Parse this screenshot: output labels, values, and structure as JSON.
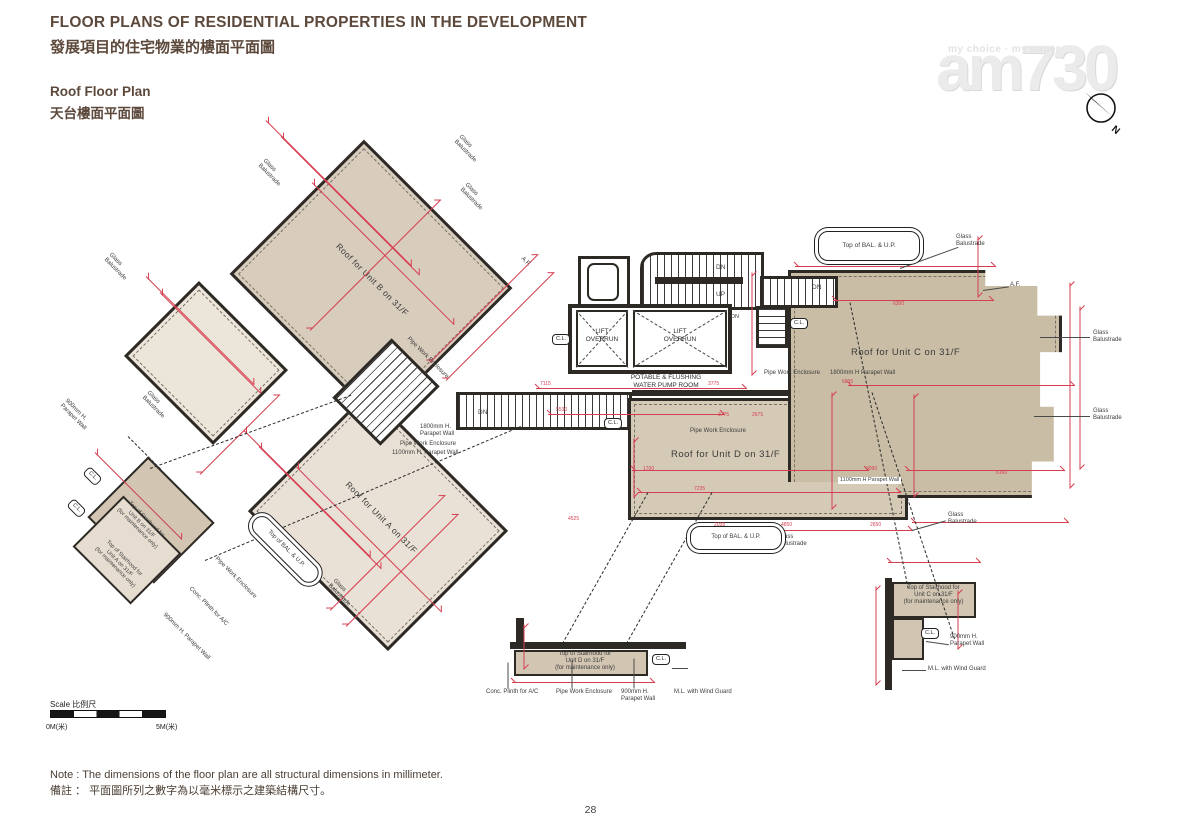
{
  "header": {
    "title_en": "FLOOR PLANS OF RESIDENTIAL PROPERTIES IN THE DEVELOPMENT",
    "title_zh": "發展項目的住宅物業的樓面平面圖",
    "subtitle_en": "Roof Floor Plan",
    "subtitle_zh": "天台樓面平面圖"
  },
  "watermark": {
    "tagline": "my choice · my paper",
    "logo": "am730",
    "compass_n": "N"
  },
  "scalebar": {
    "label": "Scale 比例尺",
    "start": "0M(米)",
    "end": "5M(米)"
  },
  "notes": {
    "en": "Note :  The dimensions of the floor plan are all structural dimensions in millimeter.",
    "zh": "備註 ： 平面圖所列之數字為以毫米標示之建築結構尺寸。"
  },
  "page_number": "28",
  "plan": {
    "rooms": {
      "unit_a": "Roof for Unit A on 31/F",
      "unit_b": "Roof for Unit B on 31/F",
      "unit_c": "Roof for Unit C on 31/F",
      "unit_d": "Roof for Unit D on 31/F",
      "lift_overrun": "LIFT\nOVERRUN",
      "pump_room": "POTABLE & FLUSHING\nWATER PUMP ROOM",
      "pipe_well": "PIPE\nWELL"
    },
    "colors": {
      "dim_red": "#d63f52",
      "wall": "#2d2a26",
      "title_brown": "#5d493c",
      "fill_unit_c": "#cabda5",
      "fill_unit_d": "#d5cab6",
      "fill_unit_b": "#d8ccbd",
      "fill_unit_a": "#e9e1d5"
    },
    "annotations": [
      {
        "t": "Glass\nBalustrade",
        "x": 462,
        "y": 134,
        "r": 45,
        "s": 6
      },
      {
        "t": "Glass\nBalustrade",
        "x": 468,
        "y": 182,
        "r": 45,
        "s": 6
      },
      {
        "t": "Glass\nBalustrade",
        "x": 266,
        "y": 158,
        "r": 45,
        "s": 6
      },
      {
        "t": "Glass\nBalustrade",
        "x": 112,
        "y": 252,
        "r": 45,
        "s": 6
      },
      {
        "t": "Glass\nBalustrade",
        "x": 150,
        "y": 390,
        "r": 45,
        "s": 6
      },
      {
        "t": "Glass\nBalustrade",
        "x": 336,
        "y": 578,
        "r": 45,
        "s": 6
      },
      {
        "t": "Glass\nBalustrade",
        "x": 956,
        "y": 234,
        "s": 6
      },
      {
        "t": "Glass\nBalustrade",
        "x": 1093,
        "y": 330,
        "s": 6
      },
      {
        "t": "Glass\nBalustrade",
        "x": 1093,
        "y": 408,
        "s": 6
      },
      {
        "t": "Glass\nBalustrade",
        "x": 948,
        "y": 512,
        "s": 6
      },
      {
        "t": "Glass\nBalustrade",
        "x": 778,
        "y": 534,
        "s": 6
      },
      {
        "t": "A.F.",
        "x": 1010,
        "y": 282,
        "s": 6
      },
      {
        "t": "A.F.",
        "x": 524,
        "y": 256,
        "r": 45,
        "s": 6
      },
      {
        "t": "Top of BAL. & U.P.",
        "x": 818,
        "y": 231,
        "w": 100,
        "h": 28,
        "cls": "balbox",
        "s": 6.5,
        "n": "top-of-bal-up-label"
      },
      {
        "t": "Top of BAL. & U.P.",
        "x": 690,
        "y": 526,
        "w": 90,
        "h": 22,
        "cls": "balbox",
        "s": 6,
        "n": "top-of-bal-up-label"
      },
      {
        "t": "Top of BAL. & U.P.",
        "x": 262,
        "y": 512,
        "w": 84,
        "h": 18,
        "r": 45,
        "cls": "balbox",
        "s": 6,
        "n": "top-of-bal-up-label"
      },
      {
        "t": "DN",
        "x": 716,
        "y": 264,
        "s": 6.5
      },
      {
        "t": "UP",
        "x": 716,
        "y": 291,
        "s": 6.5
      },
      {
        "t": "DN",
        "x": 812,
        "y": 284,
        "s": 6.5
      },
      {
        "t": "DN",
        "x": 478,
        "y": 409,
        "s": 6.5
      },
      {
        "t": "DN",
        "x": 731,
        "y": 314,
        "s": 5.5
      },
      {
        "t": "C.L.",
        "x": 552,
        "y": 334,
        "cls": "clbox"
      },
      {
        "t": "C.L.",
        "x": 604,
        "y": 418,
        "cls": "clbox"
      },
      {
        "t": "C.L.",
        "x": 790,
        "y": 318,
        "cls": "clbox"
      },
      {
        "t": "C.L.",
        "x": 921,
        "y": 628,
        "cls": "clbox"
      },
      {
        "t": "C.L.",
        "x": 652,
        "y": 654,
        "cls": "clbox"
      },
      {
        "t": "C.L.",
        "x": 90,
        "y": 466,
        "r": 45,
        "cls": "clbox"
      },
      {
        "t": "C.L.",
        "x": 74,
        "y": 498,
        "r": 45,
        "cls": "clbox"
      },
      {
        "t": "Pipe Work Enclosure",
        "x": 690,
        "y": 428,
        "s": 6
      },
      {
        "t": "Pipe Work Enclosure",
        "x": 764,
        "y": 370,
        "s": 6
      },
      {
        "t": "1800mm H Parapet Wall",
        "x": 830,
        "y": 370,
        "s": 6
      },
      {
        "t": "1800mm H.\nParapet Wall",
        "x": 420,
        "y": 424,
        "s": 6
      },
      {
        "t": "Pipe Work Enclosure",
        "x": 400,
        "y": 441,
        "s": 6
      },
      {
        "t": "1100mm H. Parapet Wall",
        "x": 392,
        "y": 450,
        "s": 6
      },
      {
        "t": "1100mm H Parapet Wall",
        "x": 838,
        "y": 477,
        "s": 5.5,
        "cls": "wlabel"
      },
      {
        "t": "900mm H.\nParapet Wall",
        "x": 950,
        "y": 634,
        "s": 6
      },
      {
        "t": "M.L. with Wind Guard",
        "x": 928,
        "y": 666,
        "s": 6
      },
      {
        "t": "Conc. Plinth for A/C",
        "x": 486,
        "y": 689,
        "s": 6
      },
      {
        "t": "Pipe Work Enclosure",
        "x": 556,
        "y": 689,
        "s": 6
      },
      {
        "t": "900mm H.\nParapet Wall",
        "x": 621,
        "y": 689,
        "s": 6
      },
      {
        "t": "M.L. with Wind Guard",
        "x": 674,
        "y": 689,
        "s": 6
      },
      {
        "t": "Top of Stairhood for\nUnit D on 31/F\n(for maintenance only)",
        "x": 530,
        "y": 651,
        "s": 6,
        "w": 110,
        "a": "center",
        "n": "stairhood-d-label"
      },
      {
        "t": "Top of Stairhood for\nUnit C on 31/F\n(for maintenance only)",
        "x": 886,
        "y": 585,
        "s": 6,
        "w": 95,
        "a": "center",
        "n": "stairhood-c-label"
      },
      {
        "t": "Top of Stairhood for\nUnit B on 31/F\n(for maintenance only)",
        "x": 118,
        "y": 487,
        "r": 45,
        "s": 5.5,
        "w": 86,
        "a": "center",
        "n": "stairhood-b-label"
      },
      {
        "t": "Top of Stairhood for\nUnit A on 31/F\n(for maintenance only)",
        "x": 98,
        "y": 528,
        "r": 45,
        "s": 5.5,
        "w": 80,
        "a": "center",
        "n": "stairhood-a-label"
      },
      {
        "t": "Pipe Work Enclosure",
        "x": 218,
        "y": 556,
        "r": 45,
        "s": 6
      },
      {
        "t": "Conc. Plinth for A/C",
        "x": 192,
        "y": 586,
        "r": 45,
        "s": 6
      },
      {
        "t": "900mm H. Parapet Wall",
        "x": 166,
        "y": 612,
        "r": 45,
        "s": 6
      },
      {
        "t": "900mm H.\nParapet Wall",
        "x": 68,
        "y": 398,
        "r": 45,
        "s": 6
      },
      {
        "t": "Pipe Work Enclosure",
        "x": 410,
        "y": 336,
        "r": 45,
        "s": 6
      },
      {
        "t": "7115",
        "x": 540,
        "y": 381,
        "cls": "red"
      },
      {
        "t": "3775",
        "x": 708,
        "y": 381,
        "cls": "red"
      },
      {
        "t": "5530",
        "x": 556,
        "y": 407,
        "cls": "red"
      },
      {
        "t": "3775",
        "x": 718,
        "y": 412,
        "cls": "red"
      },
      {
        "t": "2675",
        "x": 752,
        "y": 412,
        "cls": "red"
      },
      {
        "t": "6300",
        "x": 893,
        "y": 301,
        "cls": "red"
      },
      {
        "t": "6835",
        "x": 842,
        "y": 379,
        "cls": "red"
      },
      {
        "t": "7235",
        "x": 694,
        "y": 486,
        "cls": "red"
      },
      {
        "t": "1700",
        "x": 643,
        "y": 466,
        "cls": "red"
      },
      {
        "t": "3090",
        "x": 866,
        "y": 466,
        "cls": "red"
      },
      {
        "t": "6160",
        "x": 996,
        "y": 470,
        "cls": "red"
      },
      {
        "t": "4850",
        "x": 781,
        "y": 522,
        "cls": "red"
      },
      {
        "t": "2650",
        "x": 870,
        "y": 522,
        "cls": "red"
      },
      {
        "t": "4525",
        "x": 568,
        "y": 516,
        "cls": "red"
      },
      {
        "t": "2058",
        "x": 714,
        "y": 522,
        "cls": "red"
      }
    ],
    "dims": [
      {
        "x": 536,
        "y": 388,
        "l": 210,
        "r": 0
      },
      {
        "x": 548,
        "y": 414,
        "l": 176,
        "r": 0
      },
      {
        "x": 632,
        "y": 470,
        "l": 236,
        "r": 0
      },
      {
        "x": 638,
        "y": 492,
        "l": 262,
        "r": 0
      },
      {
        "x": 700,
        "y": 530,
        "l": 212,
        "r": 0
      },
      {
        "x": 912,
        "y": 522,
        "l": 156,
        "r": 0
      },
      {
        "x": 795,
        "y": 266,
        "l": 200,
        "r": 0
      },
      {
        "x": 833,
        "y": 300,
        "l": 160,
        "r": 0
      },
      {
        "x": 848,
        "y": 385,
        "l": 226,
        "r": 0
      },
      {
        "x": 906,
        "y": 470,
        "l": 158,
        "r": 0
      },
      {
        "x": 888,
        "y": 562,
        "l": 92,
        "r": 0
      },
      {
        "x": 512,
        "y": 682,
        "l": 142,
        "r": 0
      },
      {
        "x": 752,
        "y": 272,
        "l": 102,
        "r": 90
      },
      {
        "x": 1070,
        "y": 282,
        "l": 205,
        "r": 90
      },
      {
        "x": 1080,
        "y": 306,
        "l": 162,
        "r": 90
      },
      {
        "x": 978,
        "y": 236,
        "l": 60,
        "r": 90
      },
      {
        "x": 832,
        "y": 392,
        "l": 116,
        "r": 90
      },
      {
        "x": 914,
        "y": 394,
        "l": 102,
        "r": 90
      },
      {
        "x": 876,
        "y": 586,
        "l": 98,
        "r": 90
      },
      {
        "x": 958,
        "y": 590,
        "l": 58,
        "r": 90
      },
      {
        "x": 634,
        "y": 438,
        "l": 58,
        "r": 90
      },
      {
        "x": 524,
        "y": 624,
        "l": 44,
        "r": 90
      },
      {
        "x": 266,
        "y": 120,
        "l": 205,
        "r": 45
      },
      {
        "x": 281,
        "y": 136,
        "l": 195,
        "r": 45
      },
      {
        "x": 146,
        "y": 276,
        "l": 152,
        "r": 45
      },
      {
        "x": 160,
        "y": 292,
        "l": 142,
        "r": 45
      },
      {
        "x": 244,
        "y": 430,
        "l": 178,
        "r": 45
      },
      {
        "x": 259,
        "y": 446,
        "l": 172,
        "r": 45
      },
      {
        "x": 95,
        "y": 452,
        "l": 122,
        "r": 45
      },
      {
        "x": 312,
        "y": 182,
        "l": 200,
        "r": 45
      },
      {
        "x": 296,
        "y": 466,
        "l": 205,
        "r": 45
      },
      {
        "x": 430,
        "y": 362,
        "l": 152,
        "r": -45
      },
      {
        "x": 446,
        "y": 380,
        "l": 152,
        "r": -45
      },
      {
        "x": 330,
        "y": 610,
        "l": 162,
        "r": -45
      },
      {
        "x": 346,
        "y": 626,
        "l": 158,
        "r": -45
      },
      {
        "x": 200,
        "y": 474,
        "l": 112,
        "r": -45
      },
      {
        "x": 310,
        "y": 330,
        "l": 184,
        "r": -45
      }
    ],
    "dashes": [
      {
        "x": 150,
        "y": 468,
        "l": 214,
        "r": -20
      },
      {
        "x": 205,
        "y": 560,
        "l": 343,
        "r": -23
      },
      {
        "x": 850,
        "y": 302,
        "l": 292,
        "r": 78.5
      },
      {
        "x": 872,
        "y": 392,
        "l": 260,
        "r": 71.5
      },
      {
        "x": 648,
        "y": 492,
        "l": 179,
        "r": 119.5
      },
      {
        "x": 712,
        "y": 492,
        "l": 179,
        "r": 119.5
      },
      {
        "x": 128,
        "y": 436,
        "l": 46,
        "r": 45
      }
    ],
    "leaders": [
      {
        "x": 900,
        "y": 268,
        "l": 62,
        "r": -20
      },
      {
        "x": 1040,
        "y": 337,
        "l": 50,
        "r": 0
      },
      {
        "x": 1034,
        "y": 416,
        "l": 56,
        "r": 0
      },
      {
        "x": 983,
        "y": 290,
        "l": 26,
        "r": -8
      },
      {
        "x": 912,
        "y": 530,
        "l": 35,
        "r": -16
      },
      {
        "x": 748,
        "y": 548,
        "l": 29,
        "r": -16
      },
      {
        "x": 508,
        "y": 662,
        "l": 26,
        "r": 90
      },
      {
        "x": 572,
        "y": 660,
        "l": 28,
        "r": 90
      },
      {
        "x": 634,
        "y": 658,
        "l": 30,
        "r": 90
      },
      {
        "x": 672,
        "y": 668,
        "l": 16,
        "r": 0
      },
      {
        "x": 926,
        "y": 641,
        "l": 23,
        "r": 8
      },
      {
        "x": 902,
        "y": 670,
        "l": 24,
        "r": 0
      }
    ]
  }
}
